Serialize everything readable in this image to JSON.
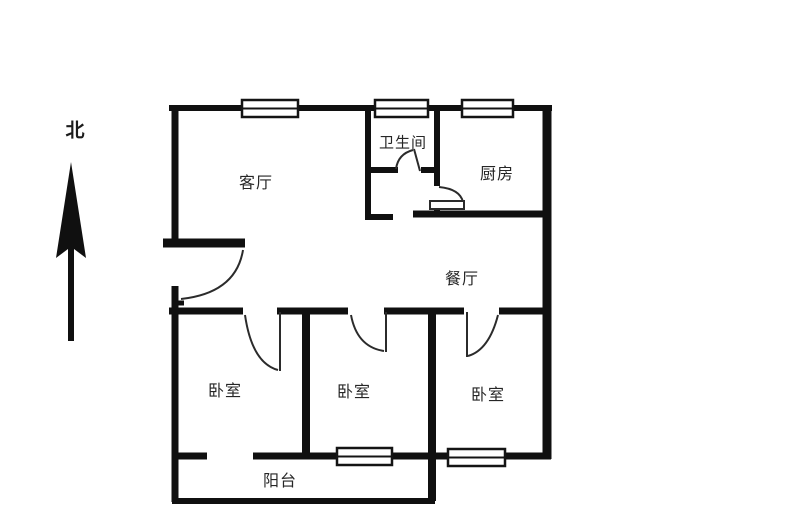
{
  "colors": {
    "background": "#ffffff",
    "walls": "#101010",
    "doors": "#2b2b2b",
    "text": "#262626"
  },
  "compass": {
    "north_label": "北"
  },
  "rooms": {
    "living_room": {
      "label": "客厅"
    },
    "bathroom": {
      "label": "卫生间"
    },
    "kitchen": {
      "label": "厨房"
    },
    "dining_room": {
      "label": "餐厅"
    },
    "bedroom_left": {
      "label": "卧室"
    },
    "bedroom_middle": {
      "label": "卧室"
    },
    "bedroom_right": {
      "label": "卧室"
    },
    "balcony": {
      "label": "阳台"
    }
  }
}
